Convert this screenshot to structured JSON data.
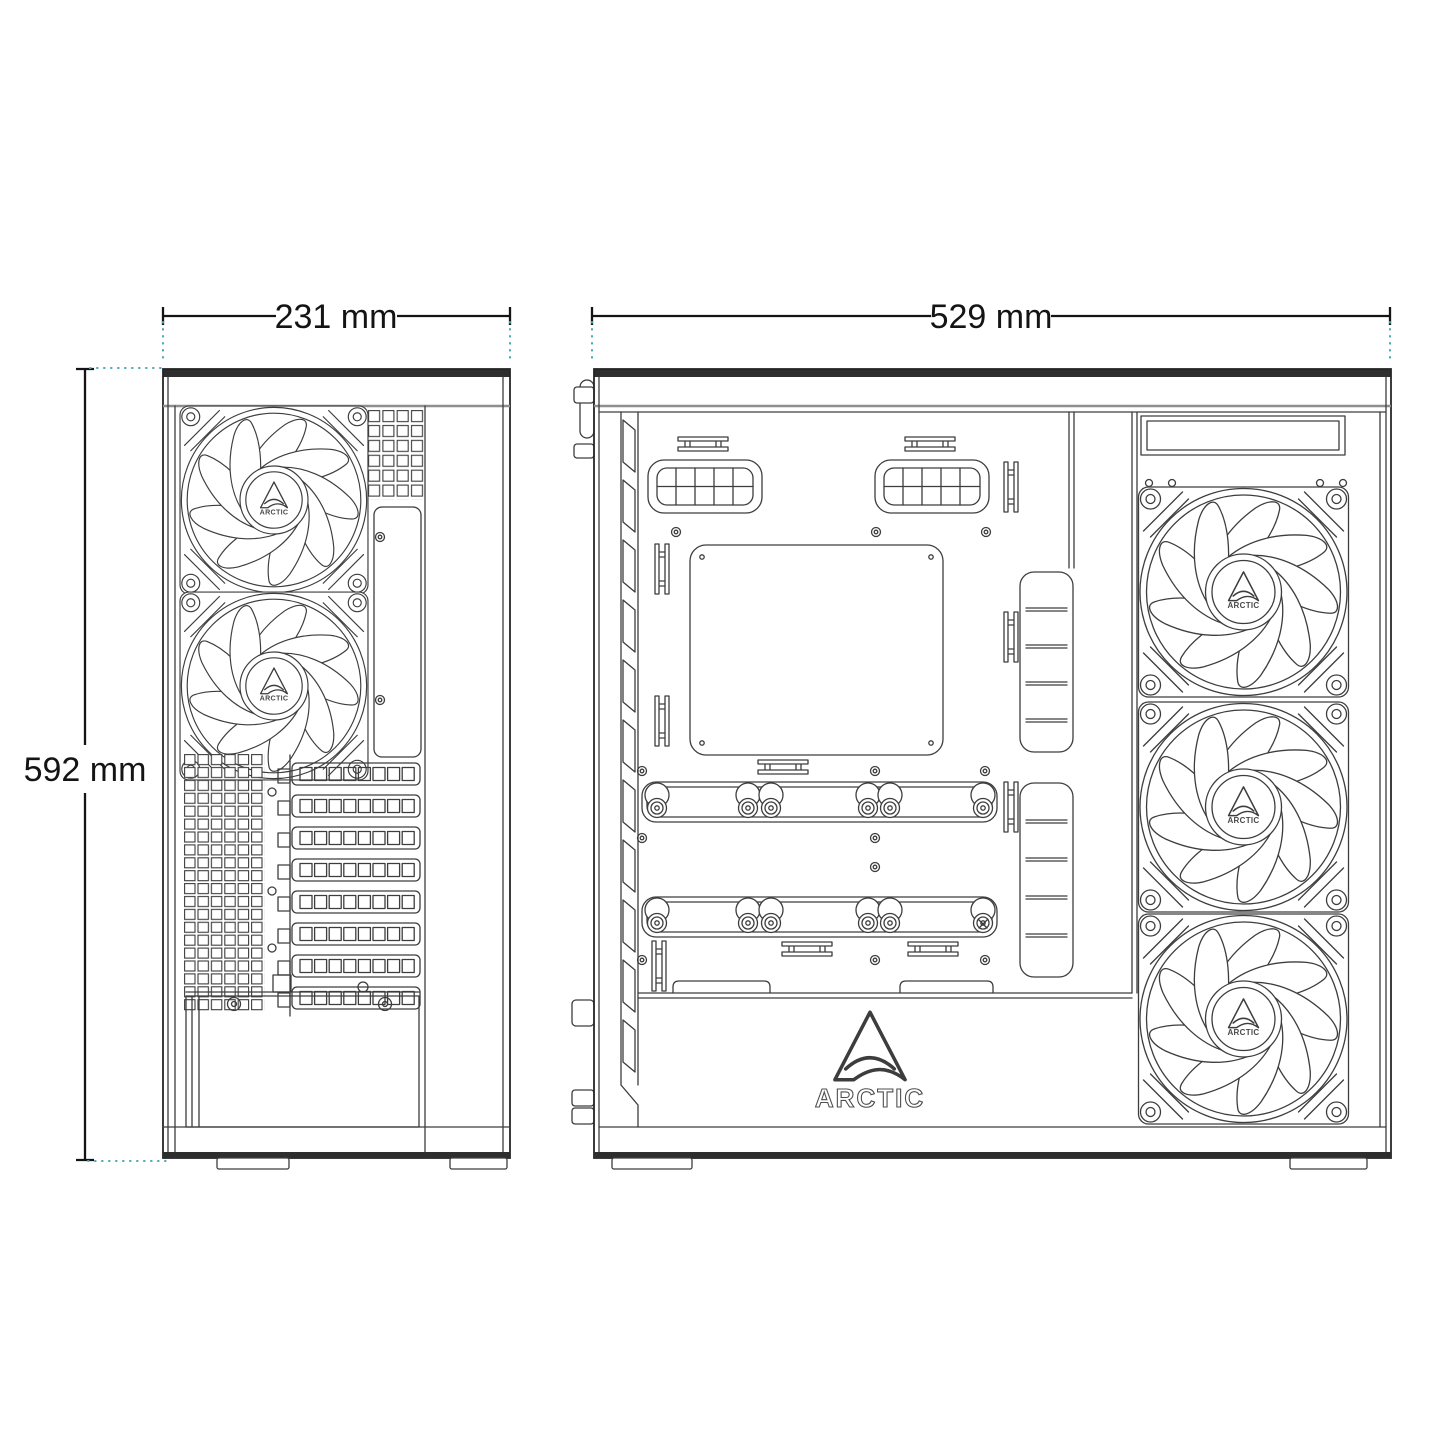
{
  "dimensions": {
    "front_width": "231 mm",
    "depth": "529 mm",
    "height": "592 mm"
  },
  "labels": {
    "fan_hub": "ARCTIC",
    "shroud_logo": "ARCTIC"
  },
  "colors": {
    "line": "#3d3d3d",
    "heavy_line": "#262626",
    "dimension": "#141414",
    "extension_teal": "#53a8b8",
    "background": "#ffffff"
  }
}
